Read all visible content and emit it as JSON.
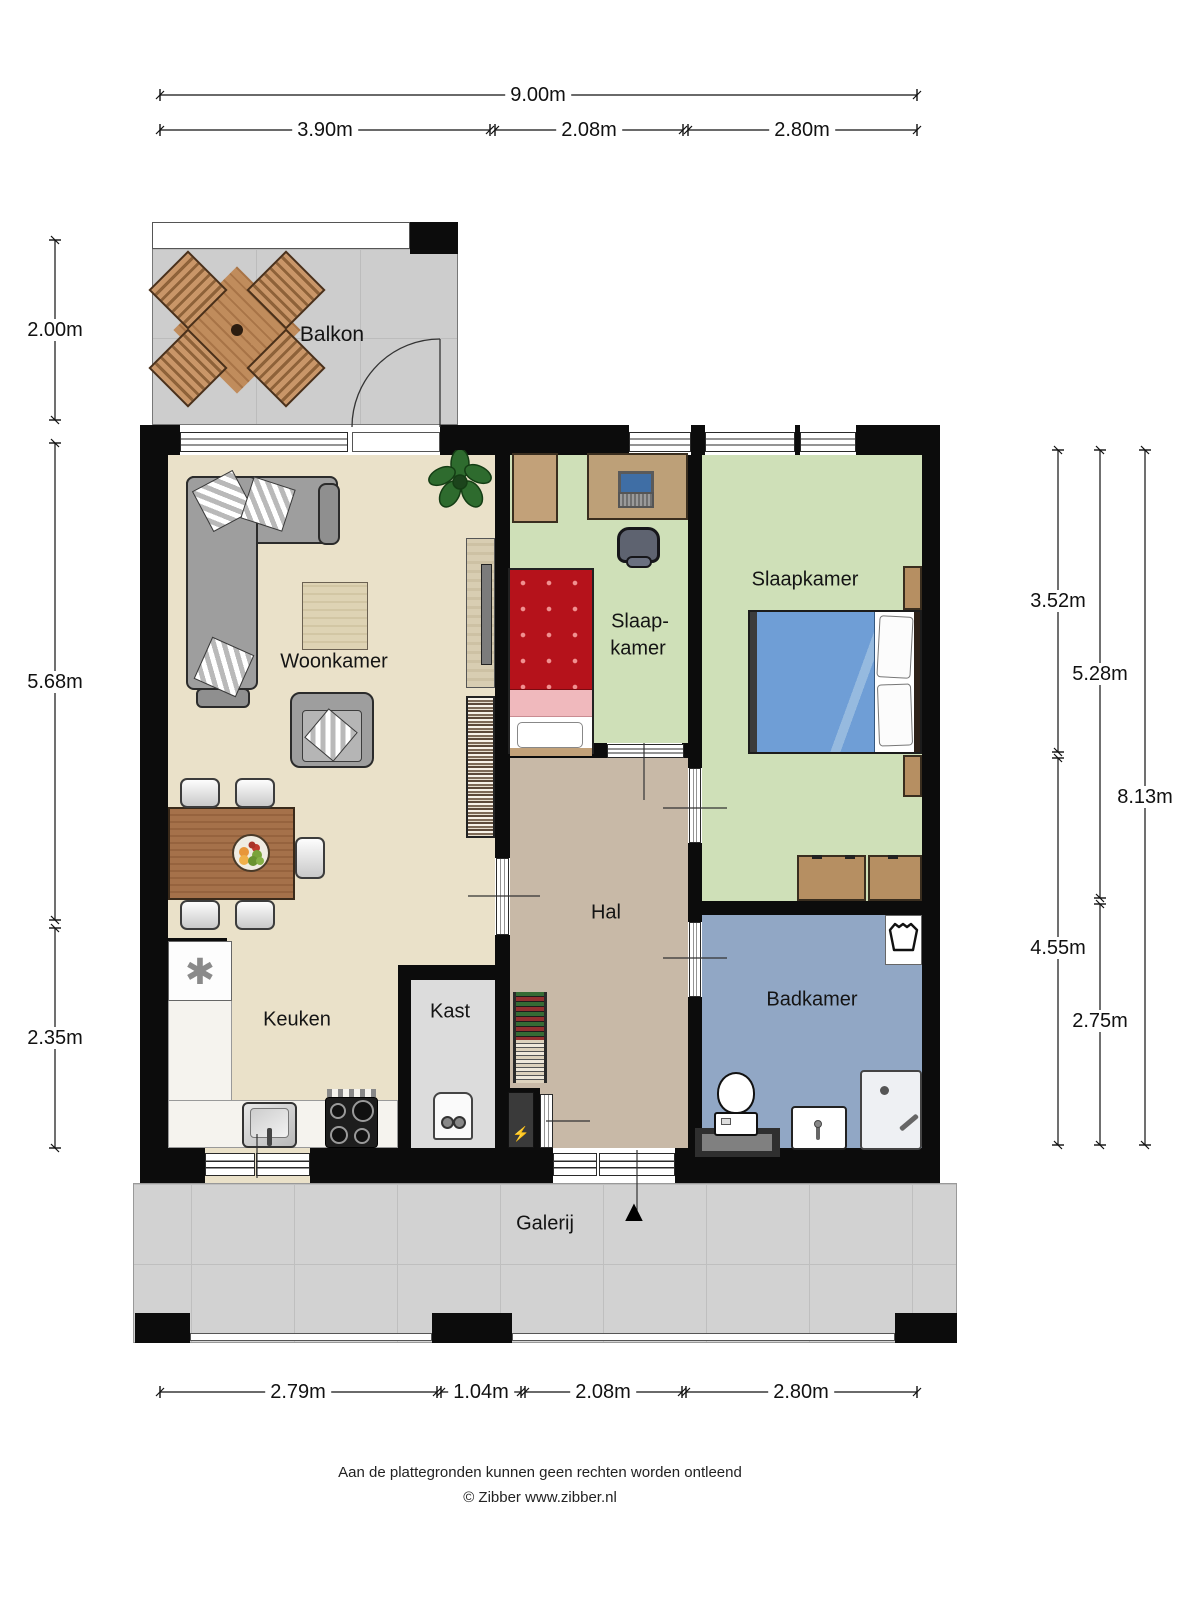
{
  "rooms": {
    "balkon": "Balkon",
    "woonkamer": "Woonkamer",
    "slaapkamer_klein": [
      "Slaap-",
      "kamer"
    ],
    "slaapkamer": "Slaapkamer",
    "hal": "Hal",
    "keuken": "Keuken",
    "kast": "Kast",
    "badkamer": "Badkamer",
    "galerij": "Galerij"
  },
  "dims": {
    "top_total": "9.00m",
    "top": [
      "3.90m",
      "2.08m",
      "2.80m"
    ],
    "left": [
      "2.00m",
      "5.68m",
      "2.35m"
    ],
    "right_a": [
      "3.52m",
      "4.55m"
    ],
    "right_b": [
      "5.28m",
      "2.75m"
    ],
    "right_c": "8.13m",
    "bottom": [
      "2.79m",
      "1.04m",
      "2.08m",
      "2.80m"
    ]
  },
  "footer": {
    "disclaimer": "Aan de plattegronden kunnen geen rechten worden ontleend",
    "copyright": "© Zibber www.zibber.nl"
  },
  "icons": {
    "frost_symbol": "✱",
    "lightning_symbol": "⚡",
    "entrance_arrow": "▲"
  },
  "colors": {
    "wall": "#0c0c0c",
    "woonkamer_floor": "#eae1c9",
    "slaapkamer_floor": "#cfe0b8",
    "hal_floor": "#c8b9a7",
    "badkamer_floor": "#91a7c5",
    "kast_floor": "#dcdcdc",
    "balkon_floor": "#cdcdcd",
    "galerij_floor": "#d2d2d2",
    "bed_double": "#6f9ed6",
    "bed_single": "#b5121b",
    "wood": "#a5714a"
  }
}
